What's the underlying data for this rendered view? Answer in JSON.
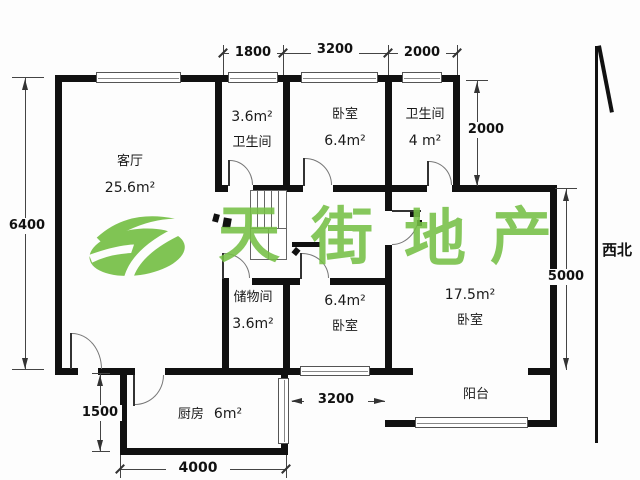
{
  "rooms": {
    "living": {
      "name": "客厅",
      "area": "25.6m²"
    },
    "bath_top": {
      "area": "3.6m²",
      "name": "卫生间"
    },
    "bed_top": {
      "name": "卧室",
      "area": "6.4m²"
    },
    "bath_right": {
      "name": "卫生间",
      "area": "4 m²"
    },
    "storage": {
      "name": "储物间",
      "area": "3.6m²"
    },
    "bed_mid": {
      "area": "6.4m²",
      "name": "卧室"
    },
    "bed_big": {
      "area": "17.5m²",
      "name": "卧室"
    },
    "balcony": {
      "name": "阳台"
    },
    "kitchen": {
      "name": "厨房",
      "area": "6m²"
    }
  },
  "dimensions": {
    "top_left": "1800",
    "top_middle": "3200",
    "top_right": "2000",
    "left_height": "6400",
    "bath_height": "2000",
    "bedroom_height": "5000",
    "kitchen_height": "1500",
    "kitchen_width": "4000",
    "middle_width": "3200"
  },
  "compass": {
    "label": "西北"
  },
  "watermark": {
    "chars": [
      "天",
      "街",
      "地",
      "产"
    ],
    "color": "#76c046"
  }
}
